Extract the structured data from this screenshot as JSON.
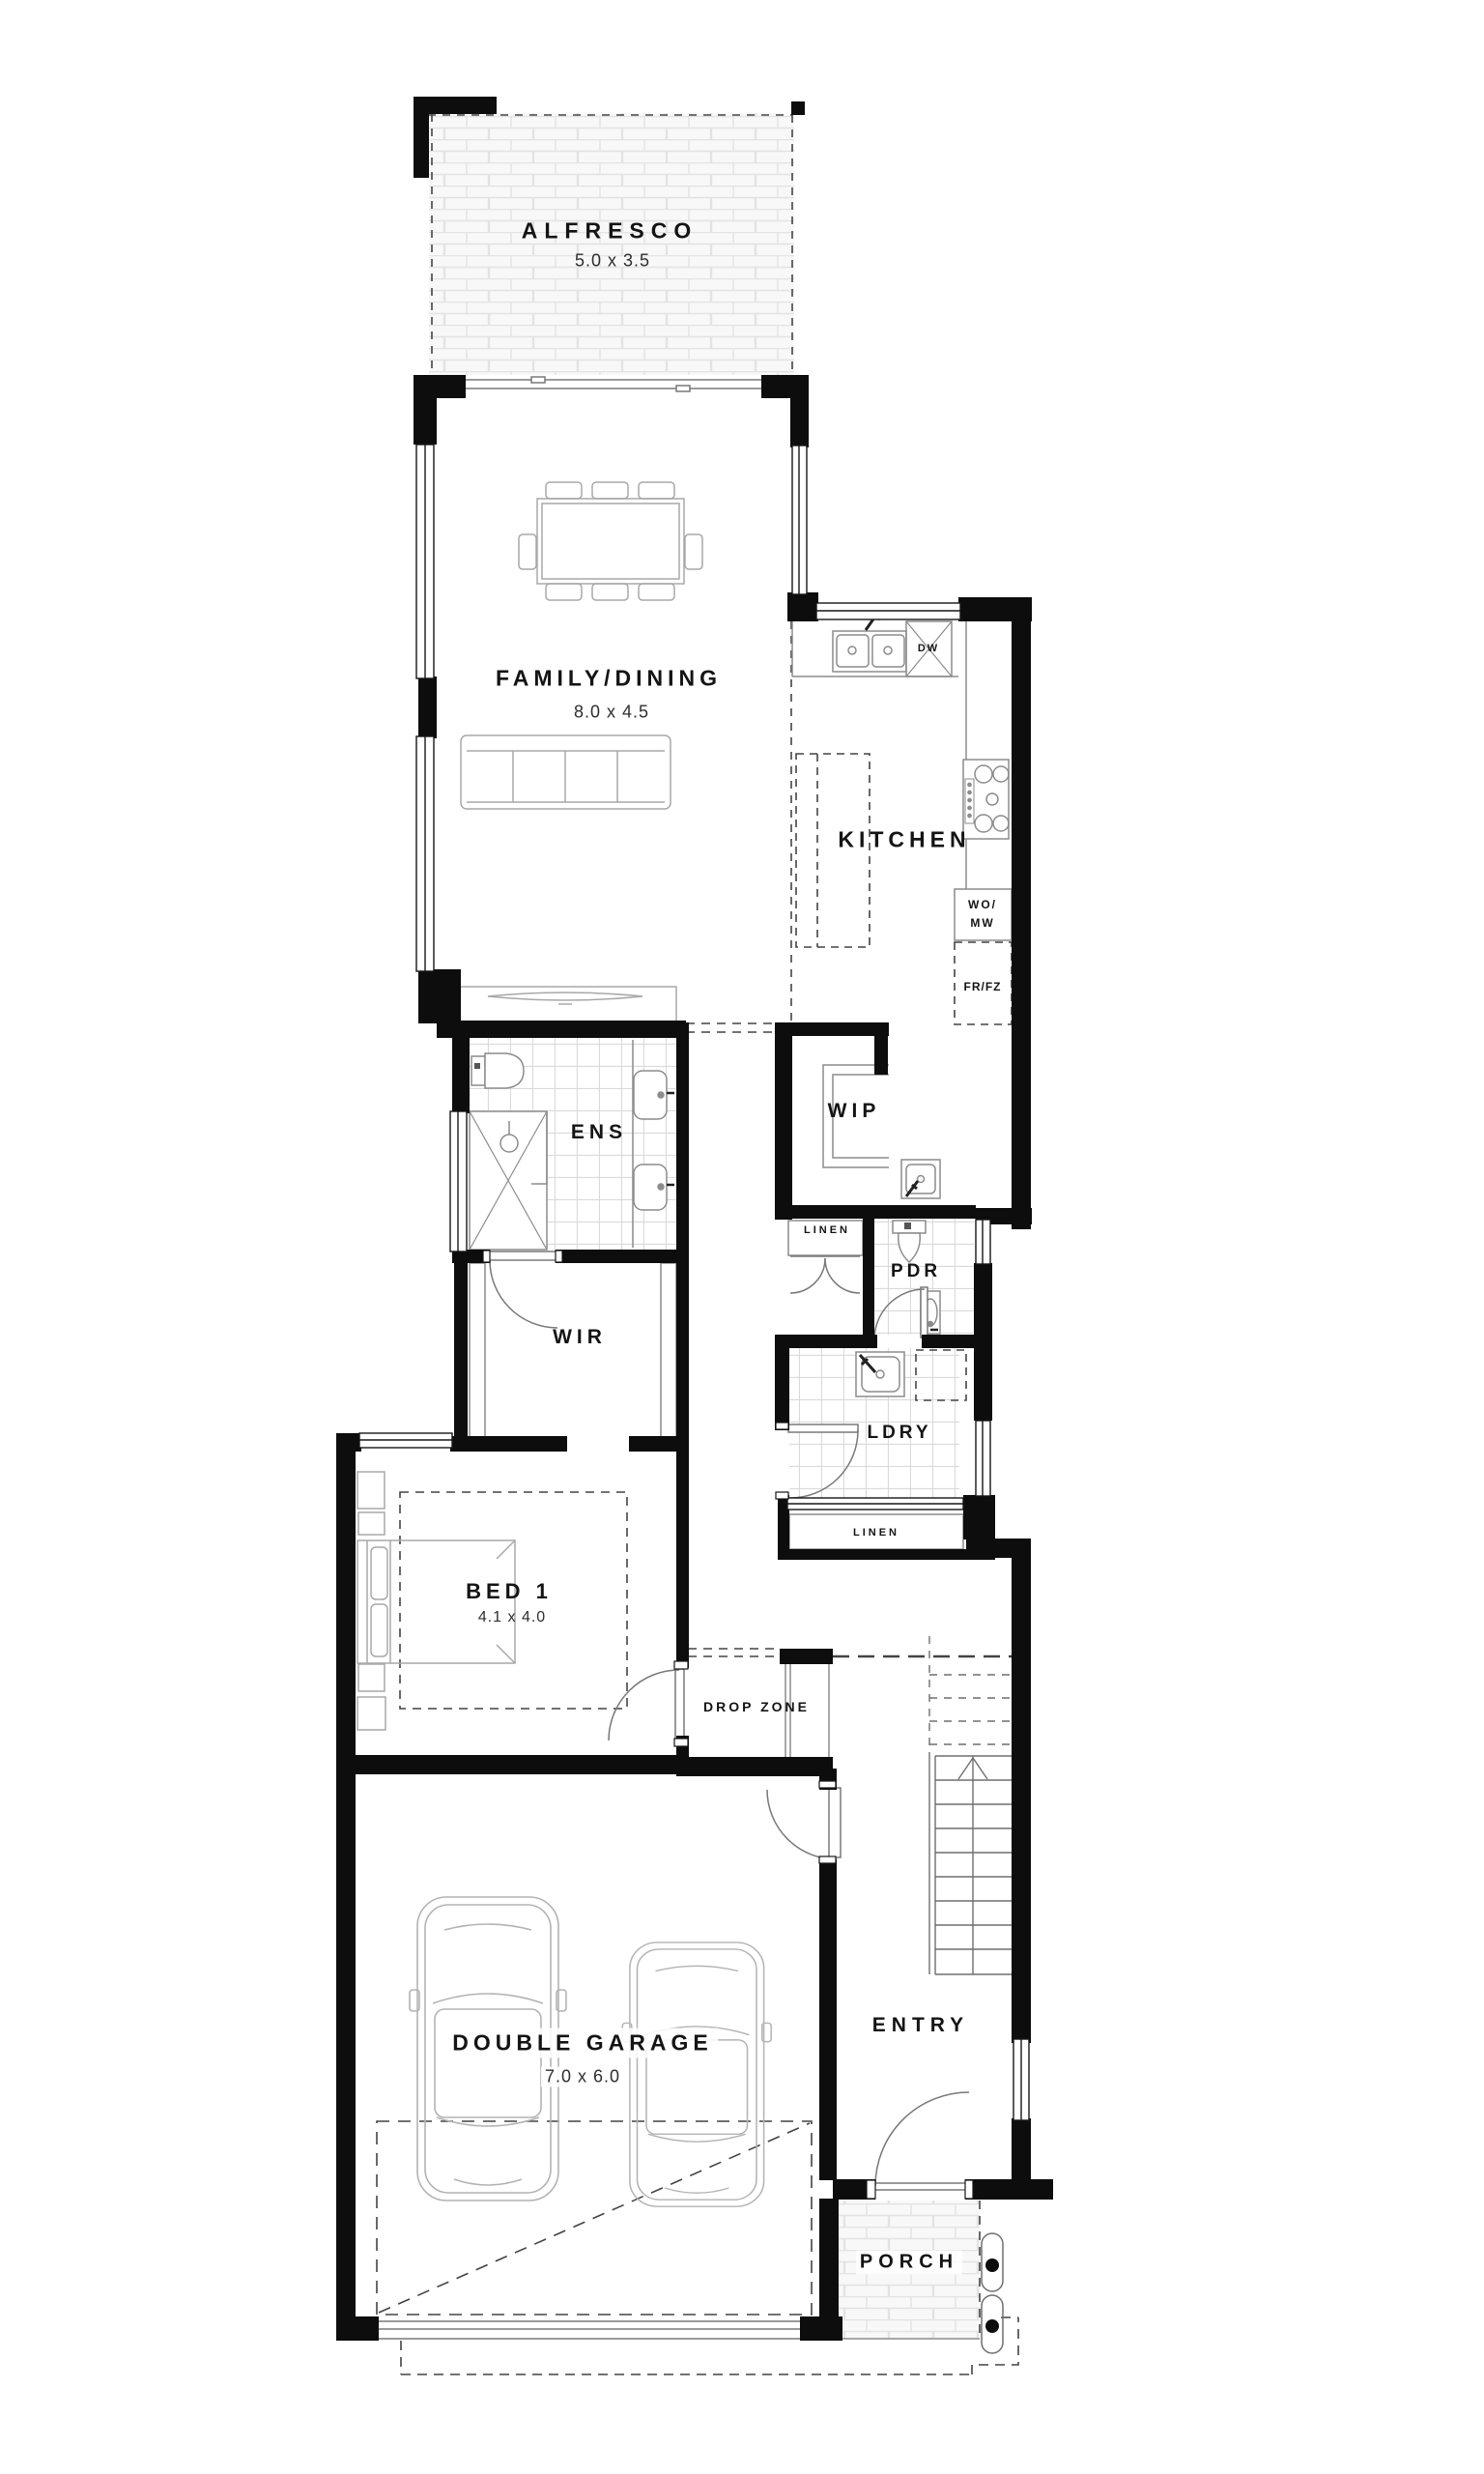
{
  "rooms": {
    "alfresco": {
      "label": "ALFRESCO",
      "dims": "5.0 x 3.5"
    },
    "family_dining": {
      "label": "FAMILY/DINING",
      "dims": "8.0 x 4.5"
    },
    "kitchen": {
      "label": "KITCHEN"
    },
    "wip": {
      "label": "WIP"
    },
    "ens": {
      "label": "ENS"
    },
    "wir": {
      "label": "WIR"
    },
    "pdr": {
      "label": "PDR"
    },
    "ldry": {
      "label": "LDRY"
    },
    "bed1": {
      "label": "BED 1",
      "dims": "4.1 x 4.0"
    },
    "drop_zone": {
      "label": "DROP ZONE"
    },
    "double_garage": {
      "label": "DOUBLE GARAGE",
      "dims": "7.0 x 6.0"
    },
    "entry": {
      "label": "ENTRY"
    },
    "porch": {
      "label": "PORCH"
    }
  },
  "storage": {
    "linen_hall": "LINEN",
    "linen_laundry": "LINEN"
  },
  "appliances": {
    "dishwasher": "DW",
    "wall_oven": "WO/",
    "microwave": "MW",
    "fridge_freezer": "FR/FZ"
  },
  "colors": {
    "wall": "#0d0d0d",
    "fixture_line": "#8c8c8c",
    "furniture_line": "#a8a8a8",
    "dash_line": "#444444",
    "tile_line": "#dadada",
    "brick_line": "#e3e3e3",
    "floor": "#ffffff"
  }
}
